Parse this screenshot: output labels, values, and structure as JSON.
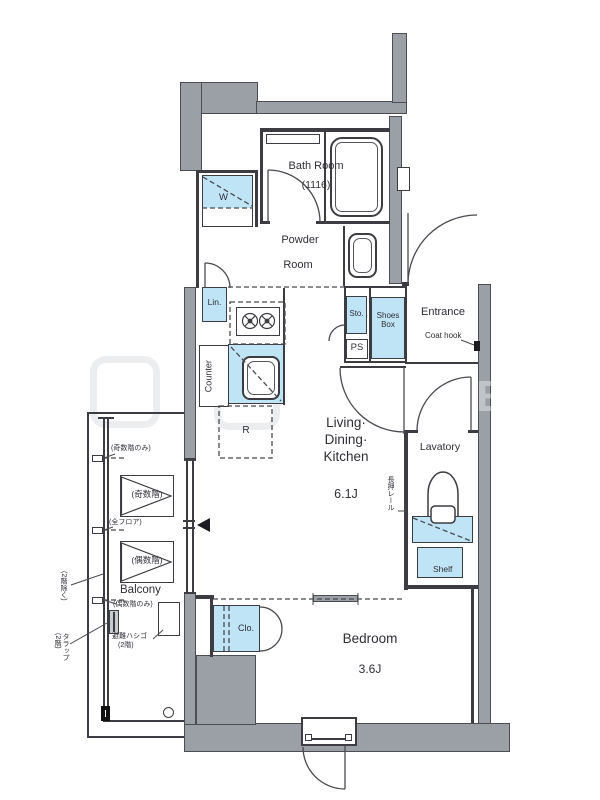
{
  "rooms": {
    "bath": {
      "name": "Bath Room",
      "size": "(1116)"
    },
    "powder": {
      "l1": "Powder",
      "l2": "Room"
    },
    "ldk": {
      "l1": "Living·",
      "l2": "Dining·",
      "l3": "Kitchen",
      "size": "6.1J"
    },
    "bedroom": {
      "name": "Bedroom",
      "size": "3.6J"
    },
    "lavatory": {
      "name": "Lavatory"
    },
    "entrance": {
      "name": "Entrance"
    }
  },
  "fixtures": {
    "washer": "W",
    "linen": "Lin.",
    "storage": "Sto.",
    "pipe_shaft": "PS",
    "shoes1": "Shoes",
    "shoes2": "Box",
    "coat_hook": "Coat hook",
    "counter": "Counter",
    "fridge": "R",
    "closet": "Clo.",
    "shelf": "Shelf",
    "rail": "長押レール"
  },
  "balcony": {
    "label": "Balcony",
    "odd": "(奇数階)",
    "even": "(偶数階)",
    "odd_only": "(奇数階のみ)",
    "all_floors": "(全フロア)",
    "even_only": "(偶数階のみ)",
    "ladder1": "避難ハシゴ",
    "ladder2": "(2階)",
    "trap": "タラップ(2階)",
    "except_2f": "(2階除く)"
  },
  "colors": {
    "wall": "#9aa0a6",
    "fixture": "#bfe4f5",
    "line": "#3c3c42"
  }
}
